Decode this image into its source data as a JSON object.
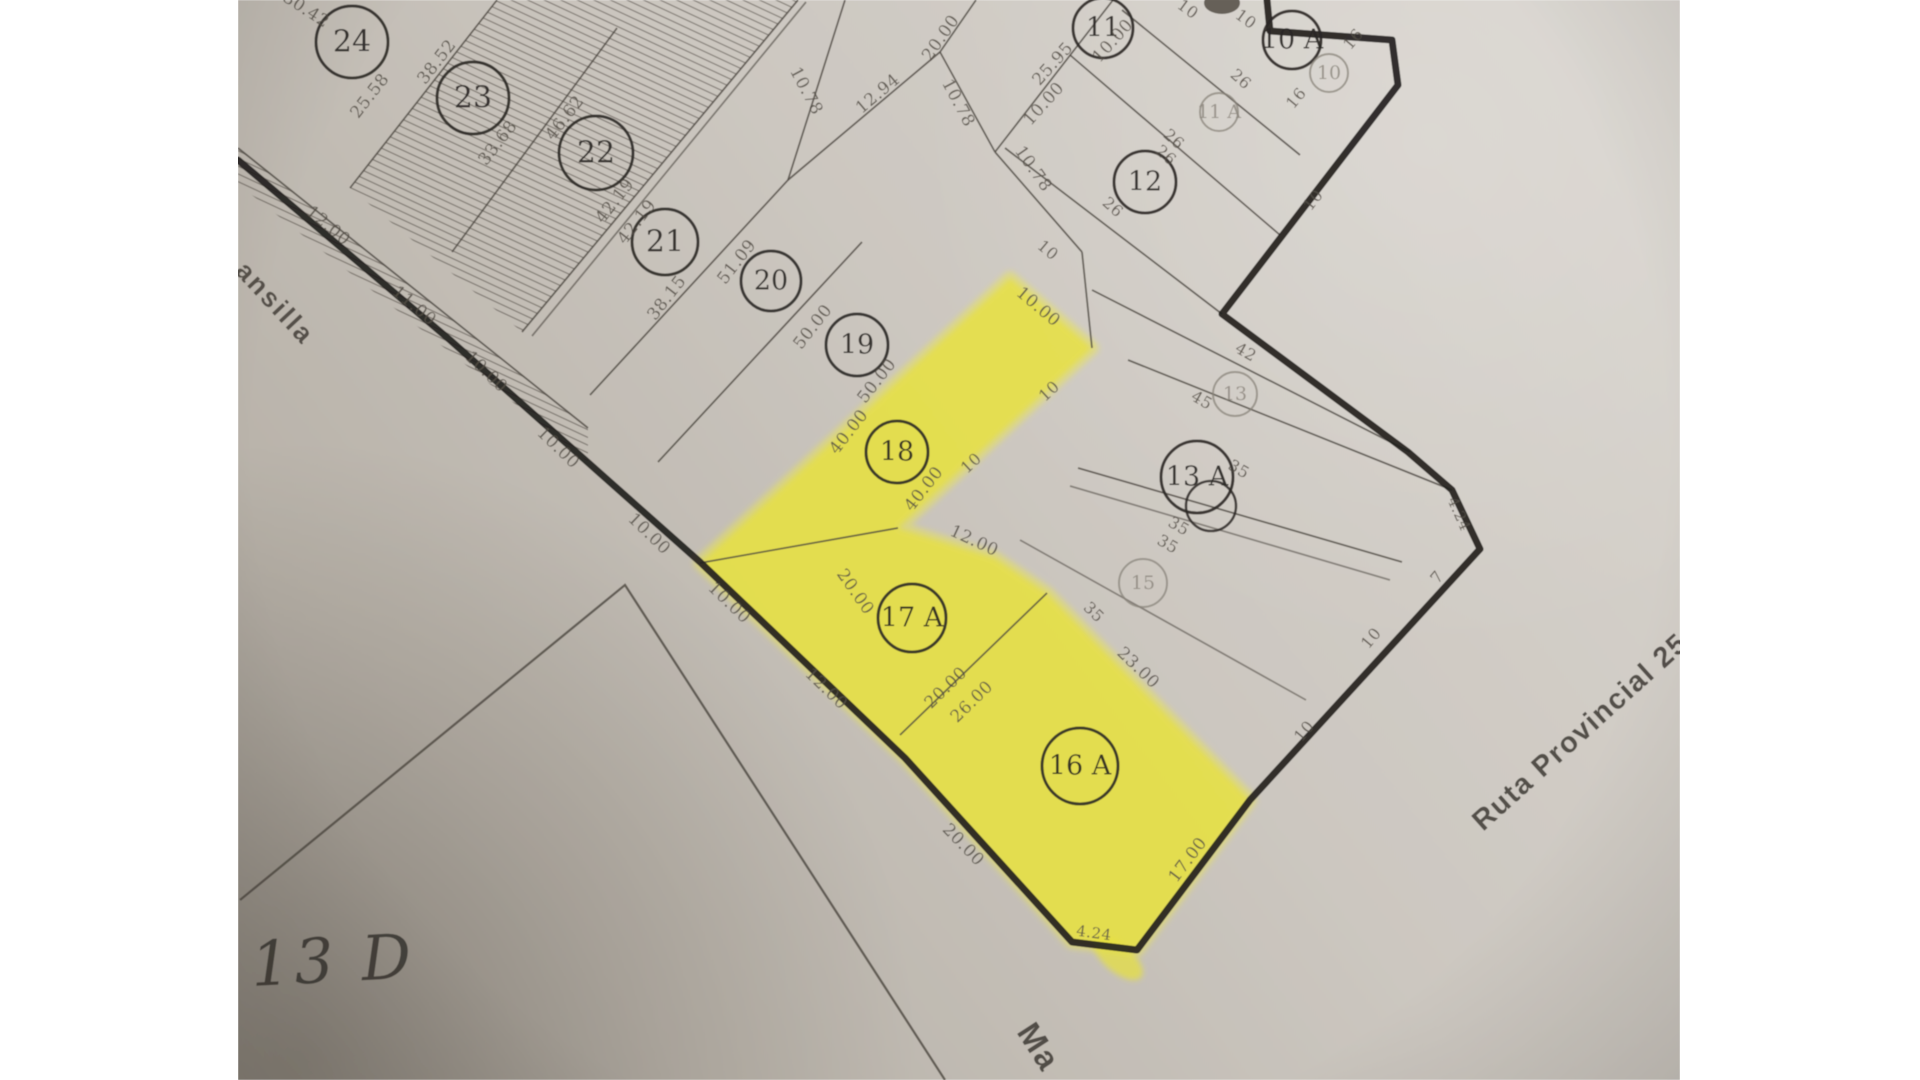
{
  "photo": {
    "left": 238,
    "right": 1680,
    "top": 0,
    "bottom": 1080
  },
  "colors": {
    "paper_light": "#d9d5cf",
    "paper_mid": "#ccc7c0",
    "paper_dark": "#b3ada4",
    "paper_corner": "#a39d94",
    "ink_thick": "#23211e",
    "ink_thin": "#4b463f",
    "ink_dim": "#544e46",
    "ink_circle": "#2b2825",
    "ink_light_circle": "#8a847b",
    "marker_yellow": "#e8e23a",
    "marker_glow": "#ece74e",
    "margin_white": "#ffffff"
  },
  "map": {
    "thick_boundary": [
      [
        238,
        160
      ],
      [
        450,
        340
      ],
      [
        700,
        562
      ],
      [
        905,
        758
      ],
      [
        1072,
        942
      ],
      [
        1137,
        950
      ],
      [
        1250,
        800
      ],
      [
        1480,
        549
      ],
      [
        1452,
        490
      ],
      [
        1408,
        452
      ],
      [
        1222,
        314
      ],
      [
        1398,
        85
      ],
      [
        1392,
        40
      ],
      [
        1270,
        31
      ],
      [
        1267,
        0
      ]
    ],
    "street_edge": [
      [
        240,
        900
      ],
      [
        625,
        585
      ],
      [
        945,
        1080
      ]
    ],
    "thin_lines": [
      {
        "p": [
          497,
          0,
          350,
          188
        ]
      },
      {
        "p": [
          617,
          28,
          452,
          252
        ]
      },
      {
        "p": [
          798,
          0,
          522,
          332
        ]
      },
      {
        "p": [
          806,
          2,
          532,
          336
        ],
        "o": 0.6
      },
      {
        "p": [
          845,
          0,
          788,
          180
        ]
      },
      {
        "p": [
          788,
          180,
          590,
          395
        ]
      },
      {
        "p": [
          862,
          242,
          658,
          462
        ]
      },
      {
        "p": [
          238,
          148,
          588,
          428
        ]
      },
      {
        "p": [
          788,
          180,
          940,
          52
        ]
      },
      {
        "p": [
          940,
          52,
          976,
          0
        ]
      },
      {
        "p": [
          940,
          52,
          995,
          152
        ]
      },
      {
        "p": [
          995,
          152,
          1082,
          252
        ]
      },
      {
        "p": [
          1082,
          252,
          1092,
          348
        ]
      },
      {
        "p": [
          995,
          152,
          1113,
          0
        ]
      },
      {
        "p": [
          1122,
          10,
          1300,
          155
        ]
      },
      {
        "p": [
          1070,
          55,
          1280,
          235
        ]
      },
      {
        "p": [
          1005,
          148,
          1222,
          314
        ]
      },
      {
        "p": [
          1092,
          290,
          1410,
          452
        ]
      },
      {
        "p": [
          1128,
          360,
          1452,
          490
        ]
      },
      {
        "p": [
          1078,
          468,
          1402,
          562
        ]
      },
      {
        "p": [
          1070,
          486,
          1390,
          580
        ],
        "o": 0.55
      },
      {
        "p": [
          1020,
          540,
          1306,
          700
        ],
        "o": 0.55
      },
      {
        "p": [
          898,
          528,
          700,
          563
        ]
      },
      {
        "p": [
          900,
          735,
          1047,
          593
        ]
      }
    ],
    "hatch_polygons": [
      [
        [
          497,
          0
        ],
        [
          798,
          0
        ],
        [
          522,
          332
        ],
        [
          350,
          188
        ]
      ],
      [
        [
          238,
          148
        ],
        [
          588,
          428
        ],
        [
          588,
          462
        ],
        [
          238,
          184
        ]
      ]
    ],
    "yellow_blob": [
      [
        1010,
        278
      ],
      [
        1092,
        348
      ],
      [
        898,
        528
      ],
      [
        995,
        558
      ],
      [
        1047,
        593
      ],
      [
        1250,
        800
      ],
      [
        1137,
        950
      ],
      [
        1072,
        942
      ],
      [
        905,
        758
      ],
      [
        700,
        563
      ]
    ],
    "yellow_overshoot": {
      "cx": 1118,
      "cy": 958,
      "rx": 30,
      "ry": 14,
      "rot": 40
    },
    "top_mark": {
      "cx": 1222,
      "cy": 3,
      "rx": 18,
      "ry": 11
    },
    "lot_circles": [
      {
        "n": "24",
        "x": 352,
        "y": 42,
        "r": 36
      },
      {
        "n": "23",
        "x": 473,
        "y": 98,
        "r": 36
      },
      {
        "n": "22",
        "x": 596,
        "y": 153,
        "r": 37
      },
      {
        "n": "21",
        "x": 665,
        "y": 242,
        "r": 33
      },
      {
        "n": "20",
        "x": 771,
        "y": 281,
        "r": 30
      },
      {
        "n": "19",
        "x": 857,
        "y": 345,
        "r": 31
      },
      {
        "n": "18",
        "x": 897,
        "y": 452,
        "r": 31
      },
      {
        "n": "17 A",
        "x": 912,
        "y": 618,
        "r": 34
      },
      {
        "n": "16 A",
        "x": 1080,
        "y": 766,
        "r": 38
      },
      {
        "n": "12",
        "x": 1145,
        "y": 182,
        "r": 31
      },
      {
        "n": "11",
        "x": 1103,
        "y": 28,
        "r": 30
      },
      {
        "n": "10 A",
        "x": 1292,
        "y": 40,
        "r": 29
      },
      {
        "n": "13 A",
        "x": 1197,
        "y": 477,
        "r": 36,
        "double": {
          "x": 1211,
          "y": 506,
          "r": 25
        }
      },
      {
        "n": "13",
        "x": 1235,
        "y": 394,
        "r": 22,
        "light": true
      },
      {
        "n": "15",
        "x": 1143,
        "y": 583,
        "r": 24,
        "light": true
      },
      {
        "n": "10",
        "x": 1329,
        "y": 73,
        "r": 19,
        "light": true
      },
      {
        "n": "11 A",
        "x": 1219,
        "y": 112,
        "r": 19,
        "light": true
      }
    ],
    "dimension_labels": [
      {
        "t": "30.42",
        "x": 306,
        "y": 10,
        "r": 33
      },
      {
        "t": "25.58",
        "x": 370,
        "y": 96,
        "r": -52
      },
      {
        "t": "38.52",
        "x": 437,
        "y": 62,
        "r": -52
      },
      {
        "t": "33.68",
        "x": 498,
        "y": 143,
        "r": -52
      },
      {
        "t": "46.62",
        "x": 565,
        "y": 118,
        "r": -52
      },
      {
        "t": "42.19",
        "x": 615,
        "y": 201,
        "r": -52
      },
      {
        "t": "42.19",
        "x": 637,
        "y": 222,
        "r": -52
      },
      {
        "t": "38.15",
        "x": 667,
        "y": 298,
        "r": -52
      },
      {
        "t": "51.09",
        "x": 737,
        "y": 262,
        "r": -52
      },
      {
        "t": "50.00",
        "x": 813,
        "y": 327,
        "r": -52
      },
      {
        "t": "50.00",
        "x": 877,
        "y": 381,
        "r": -52
      },
      {
        "t": "40.00",
        "x": 849,
        "y": 432,
        "r": -52
      },
      {
        "t": "40.00",
        "x": 924,
        "y": 489,
        "r": -52
      },
      {
        "t": "12.00",
        "x": 328,
        "y": 226,
        "r": 40
      },
      {
        "t": "11.00",
        "x": 414,
        "y": 306,
        "r": 40
      },
      {
        "t": "10.00",
        "x": 486,
        "y": 372,
        "r": 44
      },
      {
        "t": "10.00",
        "x": 558,
        "y": 448,
        "r": 44
      },
      {
        "t": "10.00",
        "x": 649,
        "y": 534,
        "r": 44
      },
      {
        "t": "10.00",
        "x": 729,
        "y": 603,
        "r": 44
      },
      {
        "t": "12.00",
        "x": 826,
        "y": 689,
        "r": 44
      },
      {
        "t": "20.00",
        "x": 963,
        "y": 845,
        "r": 46
      },
      {
        "t": "17.00",
        "x": 1188,
        "y": 860,
        "r": -53
      },
      {
        "t": "4.24",
        "x": 1094,
        "y": 933,
        "r": 8,
        "s": 15
      },
      {
        "t": "4.24",
        "x": 1459,
        "y": 514,
        "r": 66,
        "s": 15
      },
      {
        "t": "7",
        "x": 1437,
        "y": 577,
        "r": -50,
        "s": 16
      },
      {
        "t": "10",
        "x": 1371,
        "y": 638,
        "r": -50,
        "s": 16
      },
      {
        "t": "10",
        "x": 1304,
        "y": 731,
        "r": -50,
        "s": 16
      },
      {
        "t": "20.00",
        "x": 855,
        "y": 592,
        "r": 55
      },
      {
        "t": "20.00",
        "x": 946,
        "y": 688,
        "r": -44
      },
      {
        "t": "26.00",
        "x": 972,
        "y": 702,
        "r": -44
      },
      {
        "t": "12.00",
        "x": 974,
        "y": 541,
        "r": 25
      },
      {
        "t": "35",
        "x": 1094,
        "y": 612,
        "r": 44,
        "s": 16
      },
      {
        "t": "23.00",
        "x": 1138,
        "y": 668,
        "r": 44
      },
      {
        "t": "10.00",
        "x": 1038,
        "y": 307,
        "r": 40
      },
      {
        "t": "10",
        "x": 1048,
        "y": 250,
        "r": 40,
        "s": 16
      },
      {
        "t": "10",
        "x": 1049,
        "y": 391,
        "r": -43,
        "s": 16
      },
      {
        "t": "10",
        "x": 971,
        "y": 463,
        "r": -43,
        "s": 16
      },
      {
        "t": "42",
        "x": 1246,
        "y": 352,
        "r": 30,
        "s": 16
      },
      {
        "t": "45",
        "x": 1202,
        "y": 400,
        "r": 30,
        "s": 16
      },
      {
        "t": "35",
        "x": 1239,
        "y": 469,
        "r": 30,
        "s": 16
      },
      {
        "t": "35",
        "x": 1179,
        "y": 526,
        "r": 30,
        "s": 16
      },
      {
        "t": "35",
        "x": 1168,
        "y": 544,
        "r": 30,
        "s": 16
      },
      {
        "t": "10.78",
        "x": 806,
        "y": 91,
        "r": 62
      },
      {
        "t": "12.94",
        "x": 878,
        "y": 94,
        "r": -40
      },
      {
        "t": "20.00",
        "x": 941,
        "y": 38,
        "r": -55
      },
      {
        "t": "10.78",
        "x": 958,
        "y": 103,
        "r": 62
      },
      {
        "t": "25.95",
        "x": 1053,
        "y": 64,
        "r": -48
      },
      {
        "t": "10.00",
        "x": 1113,
        "y": 41,
        "r": -48
      },
      {
        "t": "10.00",
        "x": 1044,
        "y": 104,
        "r": -48
      },
      {
        "t": "10.78",
        "x": 1033,
        "y": 169,
        "r": 55
      },
      {
        "t": "26",
        "x": 1241,
        "y": 79,
        "r": 42,
        "s": 16
      },
      {
        "t": "26",
        "x": 1174,
        "y": 139,
        "r": 42,
        "s": 16
      },
      {
        "t": "26",
        "x": 1166,
        "y": 155,
        "r": 42,
        "s": 16
      },
      {
        "t": "26",
        "x": 1113,
        "y": 207,
        "r": 42,
        "s": 16
      },
      {
        "t": "16",
        "x": 1353,
        "y": 39,
        "r": -50,
        "s": 16
      },
      {
        "t": "16",
        "x": 1296,
        "y": 98,
        "r": -50,
        "s": 16
      },
      {
        "t": "10",
        "x": 1188,
        "y": 9,
        "r": 36,
        "s": 16
      },
      {
        "t": "10",
        "x": 1246,
        "y": 19,
        "r": 36,
        "s": 16
      },
      {
        "t": "10",
        "x": 1313,
        "y": 200,
        "r": -52,
        "s": 16
      }
    ],
    "big_texts": [
      {
        "id": "street-mansilla-partial",
        "t": "ansilla",
        "x": 234,
        "y": 272,
        "r": 47,
        "s": 27,
        "f": "sans",
        "w": "600",
        "ls": 2.5,
        "c": "#4a453e"
      },
      {
        "id": "street-ma-partial",
        "t": "Ma",
        "x": 1016,
        "y": 1032,
        "r": 57,
        "s": 33,
        "f": "sans",
        "w": "600",
        "ls": 2,
        "c": "#45413b"
      },
      {
        "id": "street-ruta-provincial-25",
        "t": "Ruta Provincial 25",
        "x": 1483,
        "y": 832,
        "r": -42,
        "s": 29,
        "f": "sans",
        "w": "600",
        "ls": 1.5,
        "c": "#46423c"
      },
      {
        "id": "lot-13d-label",
        "t": "13 D",
        "x": 252,
        "y": 986,
        "r": -3,
        "s": 62,
        "f": "serif",
        "w": "500",
        "ls": 4,
        "c": "#3c3833",
        "italic": true
      }
    ]
  }
}
